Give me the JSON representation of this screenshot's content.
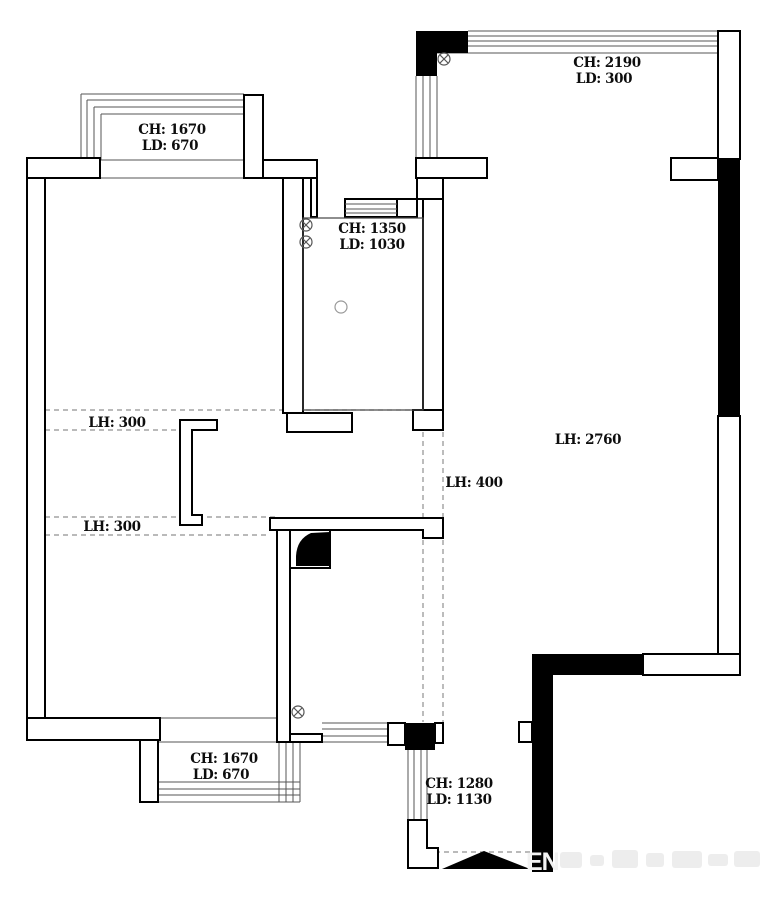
{
  "title": "apartment-floor-plan",
  "labels": {
    "bay_top_left": {
      "ch": "CH: 1670",
      "ld": "LD: 670"
    },
    "window_top_right": {
      "ch": "CH: 2190",
      "ld": "LD: 300"
    },
    "bath_top": {
      "ch": "CH: 1350",
      "ld": "LD: 1030"
    },
    "beam_upper_left": {
      "lh": "LH: 300"
    },
    "beam_lower_left": {
      "lh": "LH: 300"
    },
    "beam_center": {
      "lh": "LH: 400"
    },
    "living": {
      "lh": "LH: 2760"
    },
    "bay_bottom_left": {
      "ch": "CH: 1670",
      "ld": "LD: 670"
    },
    "entry": {
      "ch": "CH: 1280",
      "ld": "LD: 1130"
    }
  },
  "symbols": {
    "circle_cross": "light-point",
    "plain_circle": "round-fixture",
    "filled_triangle": "entrance-marker",
    "black_fill": "structural-wall"
  },
  "watermark": {
    "legible_text": "EN"
  },
  "colors": {
    "wall_fill": "#ffffff",
    "wall_stroke": "#000000",
    "structural_black": "#000000",
    "window_line": "#555555",
    "dash_line": "#909090",
    "watermark_gray": "#ececec"
  }
}
